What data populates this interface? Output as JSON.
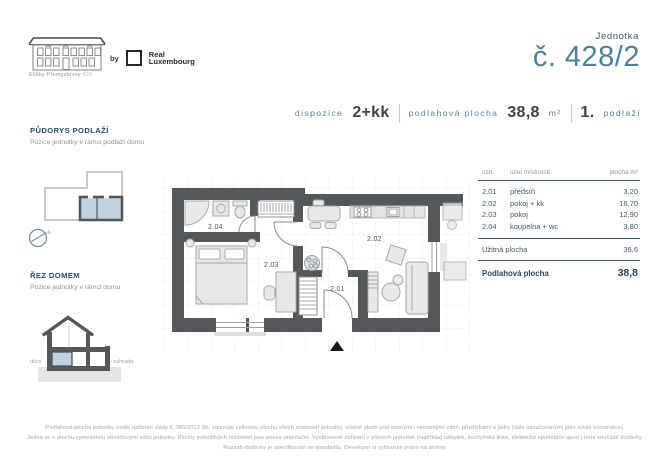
{
  "header": {
    "building_caption_name": "Elišky Přemyslovny",
    "building_caption_number": "428",
    "brand_by": "by",
    "brand_line1": "Real",
    "brand_line2": "Luxembourg",
    "unit_label": "Jednotka",
    "unit_number": "č. 428/2"
  },
  "spec": {
    "dispozice_label": "dispozice",
    "dispozice_value": "2+kk",
    "area_label": "podlahová plocha",
    "area_value": "38,8",
    "area_unit": "m²",
    "floor_value": "1.",
    "floor_label": "podlaží"
  },
  "sidebar": {
    "plan_title": "PŮDORYS PODLAŽÍ",
    "plan_subtitle": "Pozice jednotky v rámci podlaží domu",
    "compass_label": "s",
    "section_title": "ŘEZ DOMEM",
    "section_subtitle": "Pozice jednotky v rámci domu",
    "street_label": "ulice",
    "garden_label": "zahrada"
  },
  "floorplan": {
    "room_labels": {
      "r201": "2.01",
      "r202": "2.02",
      "r203": "2.03",
      "r204": "2.04"
    }
  },
  "table": {
    "header": {
      "ozn": "ozn.",
      "purpose": "účel místnosti",
      "area": "plocha m²"
    },
    "rows": [
      {
        "id": "2.01",
        "name": "předsíň",
        "area": "3,20"
      },
      {
        "id": "2.02",
        "name": "pokoj + kk",
        "area": "16,70"
      },
      {
        "id": "2.03",
        "name": "pokoj",
        "area": "12,90"
      },
      {
        "id": "2.04",
        "name": "koupelna + wc",
        "area": "3,80"
      }
    ],
    "usable_label": "Užitná plocha",
    "usable_value": "36,6",
    "total_label": "Podlahová plocha",
    "total_value": "38,8"
  },
  "footer": {
    "line1": "Podlahová plocha jednotky podle nařízení vlády č. 366/2013 Sb. zahrnuje celkovou plochu všech místností jednotky, včetně ploch pod nosnými i nenosnými zdmi, přizdívkami a jádry (dále označovanými jako svislé konstrukce).",
    "line2": "Jedná se o plochu vymezenou obvodovými zdmi jednotky. Plochy jednotlivých místností jsou pouze orientační. Vyobrazené zařízení v plánech jednotek (například nábytek, kuchyňská linka, elektrické spotřebiče apod.) není součástí dodávky.",
    "line3": "Rozsah dodávky je specifikován ve standardu. Developer si vyhrazuje právo na změny."
  },
  "colors": {
    "accent_blue": "#4d7ea0",
    "heading_navy": "#1f4e63",
    "wall": "#54585c",
    "unit_highlight": "#bfd3de"
  }
}
